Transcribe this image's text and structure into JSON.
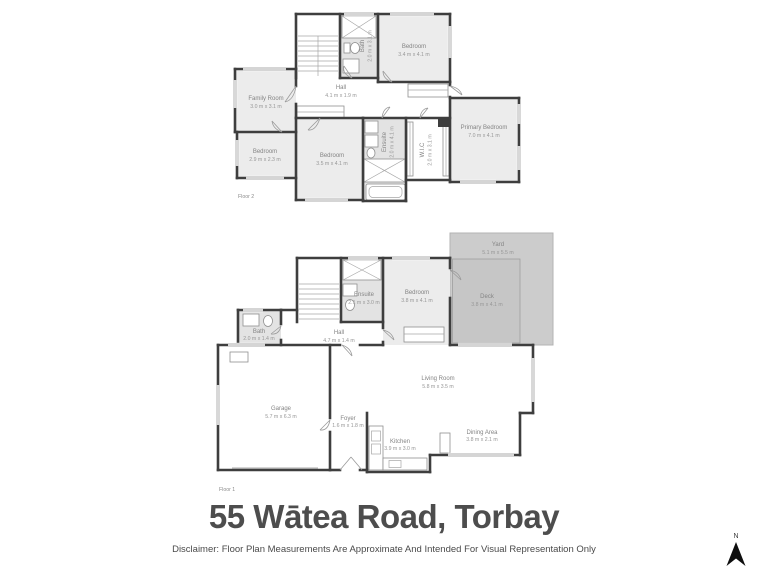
{
  "page": {
    "title": "55 Wātea Road, Torbay",
    "disclaimer": "Disclaimer: Floor Plan Measurements Are Approximate And Intended For Visual Representation Only",
    "north_label": "N"
  },
  "colors": {
    "wall": "#3e3e3e",
    "room_fill": "#ececec",
    "wet_room_fill": "#e3e3e3",
    "deck_fill": "#c6c6c6",
    "yard_fill": "#cccccc",
    "title_text": "#4d4d4d",
    "label_text": "#848484"
  },
  "floor2": {
    "label": "Floor 2",
    "rooms": {
      "family_room": {
        "name": "Family Room",
        "dims": "3.0 m x 3.1 m"
      },
      "hall": {
        "name": "Hall",
        "dims": "4.1 m x 1.9 m"
      },
      "bath": {
        "name": "Bath",
        "dims": "2.0 m x 3.1 m"
      },
      "bedroom_top": {
        "name": "Bedroom",
        "dims": "3.4 m x 4.1 m"
      },
      "primary_bedroom": {
        "name": "Primary Bedroom",
        "dims": "7.0 m x 4.1 m"
      },
      "bedroom_small": {
        "name": "Bedroom",
        "dims": "2.9 m x 2.3 m"
      },
      "bedroom_mid": {
        "name": "Bedroom",
        "dims": "3.5 m x 4.1 m"
      },
      "ensuite": {
        "name": "Ensuite",
        "dims": "2.0 m x 4.1 m"
      },
      "wic": {
        "name": "W.I.C",
        "dims": "2.0 m x 3.1 m"
      }
    }
  },
  "floor1": {
    "label": "Floor 1",
    "rooms": {
      "yard": {
        "name": "Yard",
        "dims": "5.1 m x 5.5 m"
      },
      "deck": {
        "name": "Deck",
        "dims": "3.8 m x 4.1 m"
      },
      "ensuite": {
        "name": "Ensuite",
        "dims": "2.1 m x 3.0 m"
      },
      "bedroom": {
        "name": "Bedroom",
        "dims": "3.8 m x 4.1 m"
      },
      "bath": {
        "name": "Bath",
        "dims": "2.0 m x 1.4 m"
      },
      "hall": {
        "name": "Hall",
        "dims": "4.7 m x 1.4 m"
      },
      "garage": {
        "name": "Garage",
        "dims": "5.7 m x 6.3 m"
      },
      "living_room": {
        "name": "Living Room",
        "dims": "5.8 m x 3.5 m"
      },
      "foyer": {
        "name": "Foyer",
        "dims": "1.6 m x 1.8 m"
      },
      "kitchen": {
        "name": "Kitchen",
        "dims": "3.9 m x 3.0 m"
      },
      "dining": {
        "name": "Dining Area",
        "dims": "3.8 m x 2.1 m"
      }
    }
  }
}
